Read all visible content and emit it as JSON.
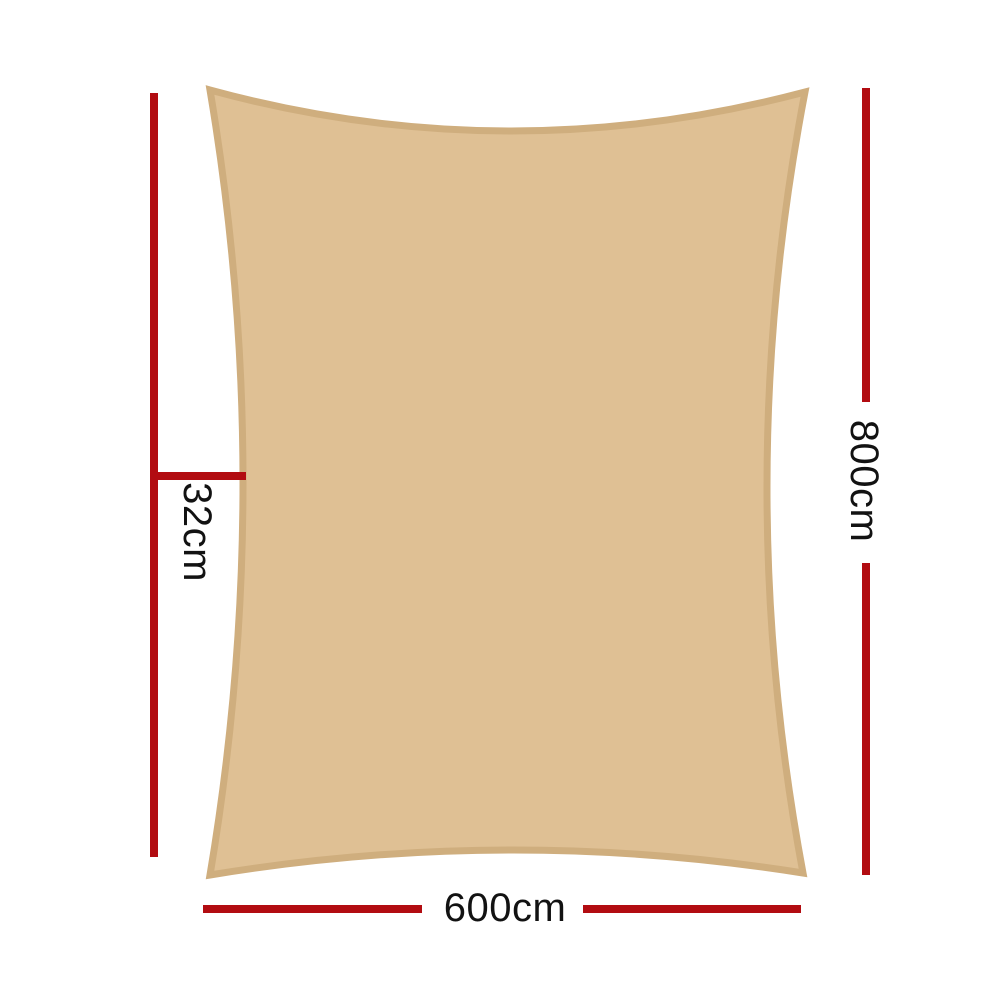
{
  "diagram_type": "product-dimension-diagram",
  "shape": "shade-sail-rectangle-concave-edges",
  "dimensions": {
    "width_label": "600cm",
    "height_label": "800cm",
    "offset_label": "32cm"
  },
  "colors": {
    "sail_fill": "#dfc094",
    "sail_border": "#cfae7e",
    "dimension_line": "#b20c11",
    "label_text": "#121212",
    "background": "#ffffff"
  }
}
